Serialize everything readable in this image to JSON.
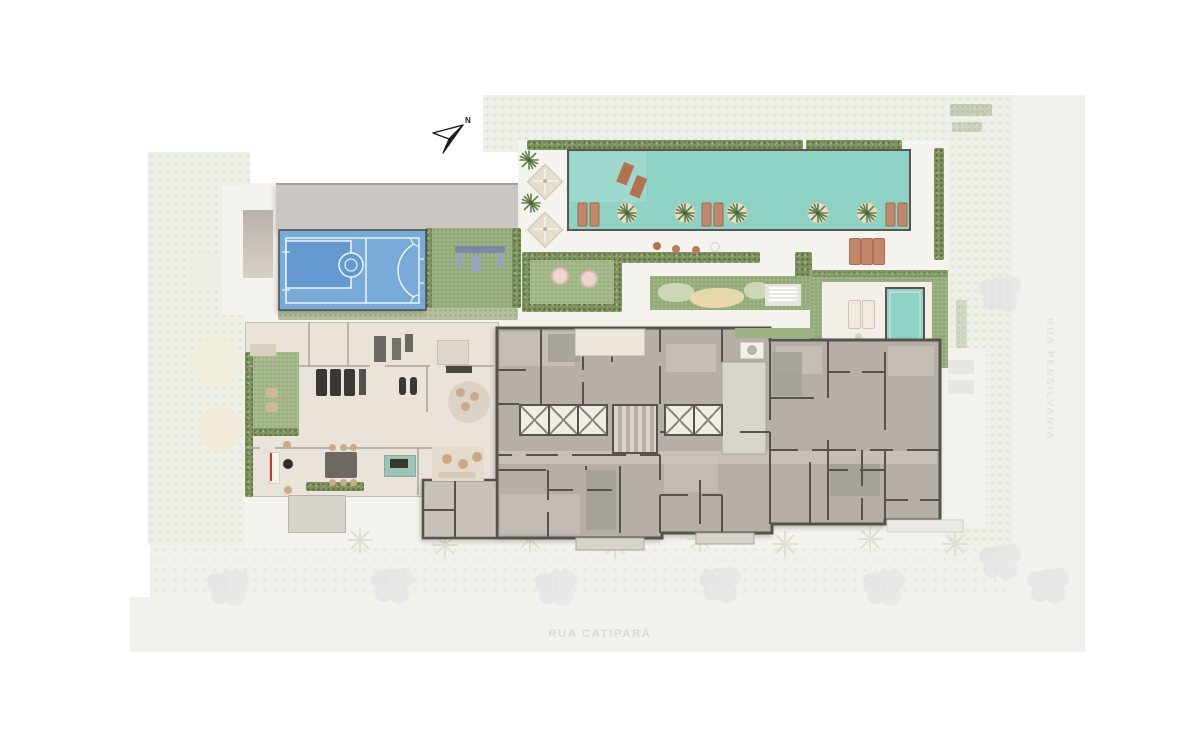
{
  "north": {
    "label": "N"
  },
  "streets": {
    "bottom": "RUA CATIPARÁ",
    "right": "RUA PENSILVANIA"
  },
  "colors": {
    "background": "#ffffff",
    "site_base": "#f5f3ee",
    "context_green": "#edf0e7",
    "street": "#f1f1ee",
    "sidewalk": "#eff1ea",
    "tree_faint": "#e0e0e4",
    "palm_shadow": "#d8e0cd",
    "roof": "#cac7c2",
    "ramp": "#b9b2a9",
    "court_blue": "#79abd9",
    "court_blue_dark": "#6499cf",
    "court_line": "#eef5fb",
    "hedge": "#7e935e",
    "hedge_pale": "#b4c19e",
    "lawn": "#9cb484",
    "lawn_bright": "#a6bc8c",
    "pool_water": "#8ed1c5",
    "pool_ledge": "#9cd8cc",
    "pool_border": "#5a564f",
    "deck": "#f3efe8",
    "sand": "#e9d8ab",
    "bush": "#ccd7b6",
    "amenity_floor": "#e9e3d9",
    "amenity_wall": "#aba59d",
    "building_floor": "#b5afa8",
    "building_floor_light": "#c7c1ba",
    "building_floor_dark": "#a49e97",
    "building_wall": "#57524c",
    "patio": "#ece6dc",
    "porch": "#d8d3cc",
    "elevator": "#f0ede7",
    "elevator_x": "#8a857e",
    "island": "#e9dfc8",
    "lounger_tan": "#c08868",
    "lounger_dark": "#b5714f",
    "umbrella": "#e5decf",
    "pouf_pink": "#ecd5cd",
    "equipment_dark": "#3a3835",
    "equipment_gray": "#6b6762",
    "table_dark": "#6e6862",
    "chair_tan": "#c9ab8a",
    "bar_teal": "#9cc3b6",
    "rug": "#ddd3c5",
    "rug_beige": "#e4dbcd",
    "desk_red": "#b5432f",
    "playground": "#7d86a6",
    "north_arrow": "#1c1c1c",
    "street_text": "#d9d9d5",
    "street_text_right": "#e2e2de"
  }
}
